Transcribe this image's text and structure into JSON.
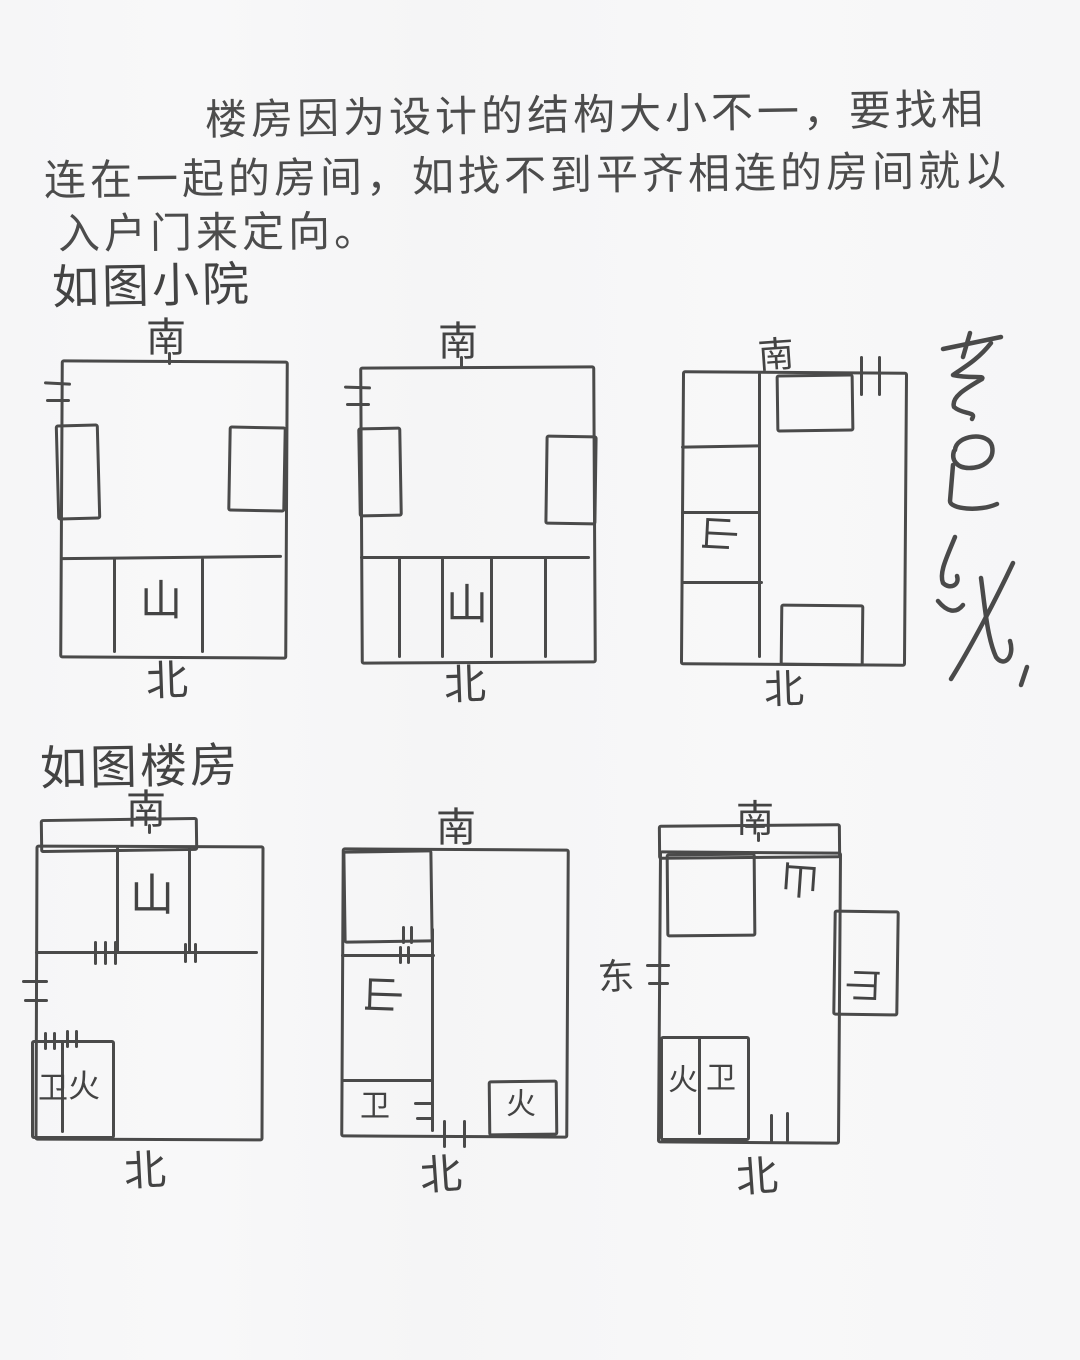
{
  "paper": {
    "background": "#f7f7f8",
    "ink": "#4a4a4a"
  },
  "note": {
    "line1": "楼房因为设计的结构大小不一，要找相",
    "line2": "连在一起的房间，如找不到平齐相连的房间就以",
    "line3": "入户门来定向。"
  },
  "sections": {
    "courtyard_heading": "如图小院",
    "building_heading": "如图楼房"
  },
  "labels": {
    "south": "南",
    "north": "北",
    "east": "东",
    "mountain": "山",
    "bathroom": "卫",
    "kitchen": "火"
  },
  "annotation": {
    "approx_text": "专连说"
  }
}
